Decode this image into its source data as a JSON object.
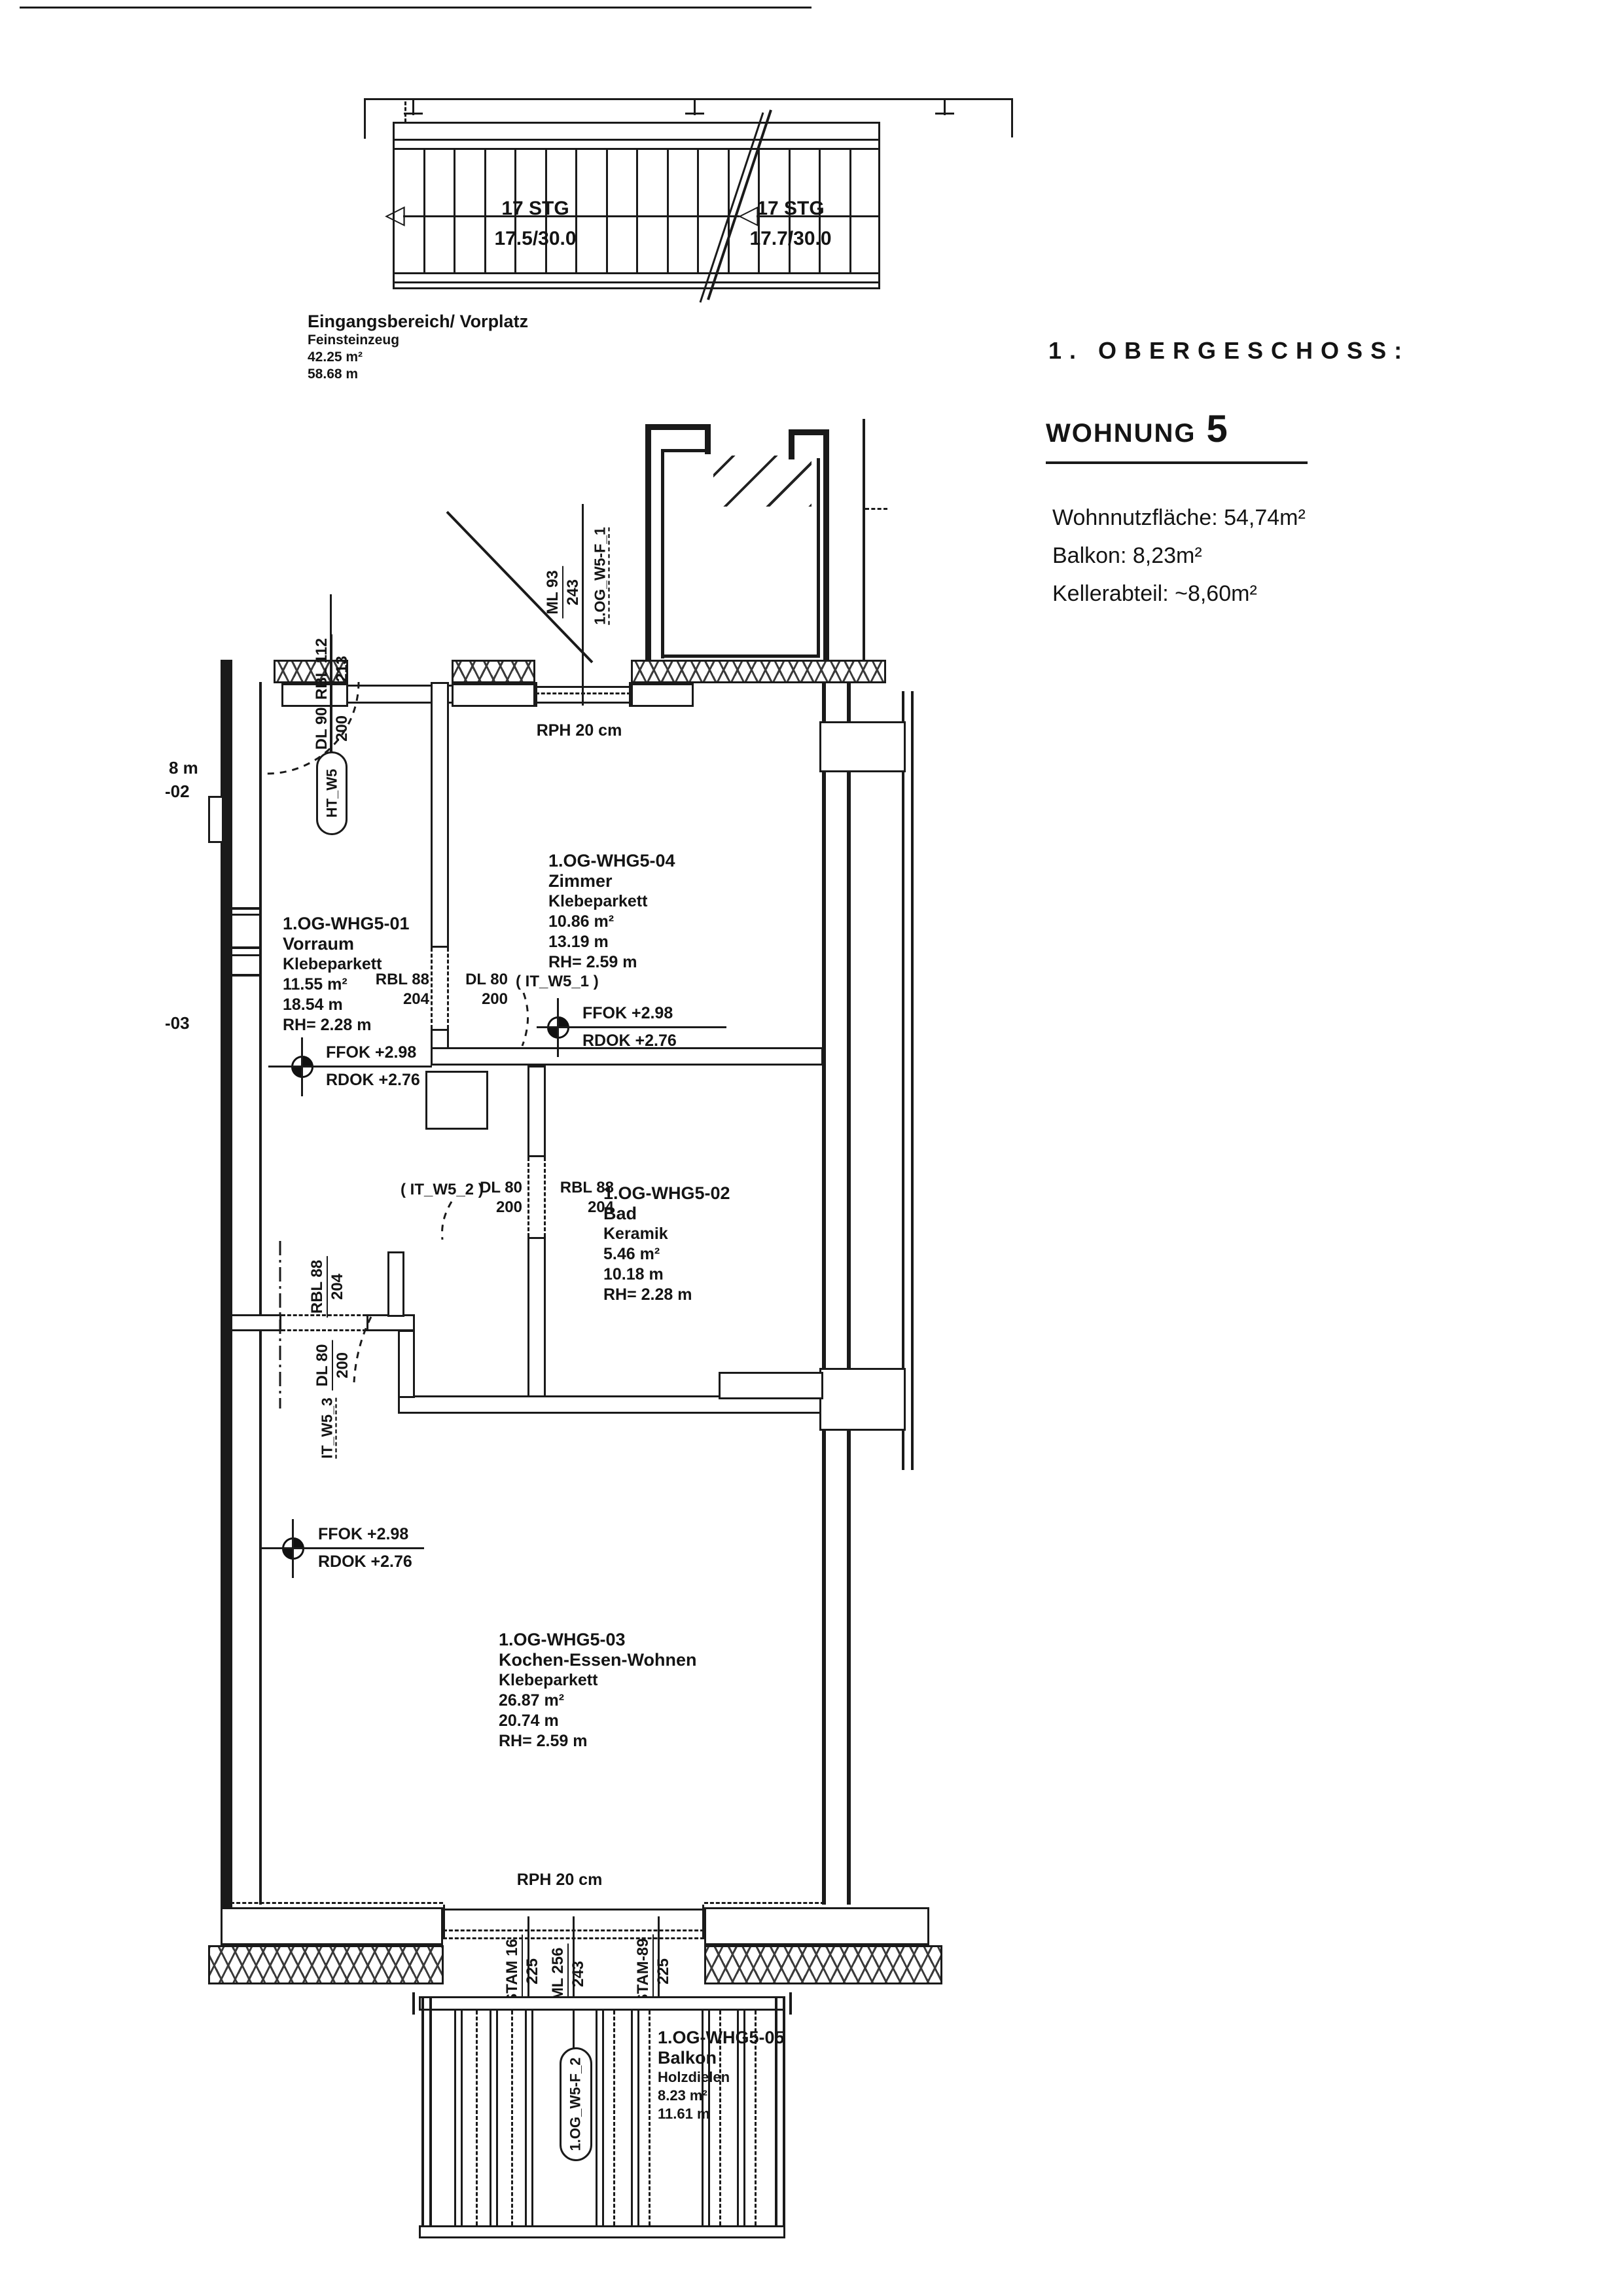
{
  "page": {
    "floor_title": "1. OBERGESCHOSS:",
    "unit_label": "WOHNUNG",
    "unit_number": "5",
    "living_area": "Wohnnutzfläche: 54,74m²",
    "balcony_area": "Balkon: 8,23m²",
    "cellar_area": "Kellerabteil: ~8,60m²"
  },
  "stairs": {
    "flight1_steps": "17 STG",
    "flight1_dim": "17.5/30.0",
    "flight2_steps": "17 STG",
    "flight2_dim": "17.7/30.0"
  },
  "entrance": {
    "name": "Eingangsbereich/ Vorplatz",
    "finish": "Feinsteinzeug",
    "area": "42.25 m²",
    "perimeter": "58.68 m"
  },
  "rooms": {
    "vorraum": {
      "id": "1.OG-WHG5-01",
      "name": "Vorraum",
      "finish": "Klebeparkett",
      "area": "11.55 m²",
      "perimeter": "18.54 m",
      "height": "RH= 2.28 m"
    },
    "zimmer": {
      "id": "1.OG-WHG5-04",
      "name": "Zimmer",
      "finish": "Klebeparkett",
      "area": "10.86 m²",
      "perimeter": "13.19 m",
      "height": "RH= 2.59 m"
    },
    "bad": {
      "id": "1.OG-WHG5-02",
      "name": "Bad",
      "finish": "Keramik",
      "area": "5.46 m²",
      "perimeter": "10.18 m",
      "height": "RH= 2.28 m"
    },
    "kochen": {
      "id": "1.OG-WHG5-03",
      "name": "Kochen-Essen-Wohnen",
      "finish": "Klebeparkett",
      "area": "26.87 m²",
      "perimeter": "20.74 m",
      "height": "RH= 2.59 m"
    },
    "balkon": {
      "id": "1.OG-WHG5-05",
      "name": "Balkon",
      "finish": "Holzdielen",
      "area": "8.23 m²",
      "perimeter": "11.61 m"
    }
  },
  "levels": {
    "ffok": "FFOK +2.98",
    "rdok": "RDOK +2.76"
  },
  "doors": {
    "entry": {
      "tag": "HT_W5",
      "dl": "DL 90",
      "dl_h": "200",
      "rbl": "RBL 112",
      "rbl_h": "213"
    },
    "window_top": {
      "tag": "1.OG_W5-F_1",
      "ml": "ML 93",
      "ml_h": "243"
    },
    "zimmer": {
      "rbl": "RBL 88",
      "rbl_h": "204",
      "dl": "DL 80",
      "dl_h": "200",
      "it": "( IT_W5_1 )"
    },
    "bad": {
      "it": "( IT_W5_2 )",
      "dl": "DL 80",
      "dl_h": "200",
      "rbl": "RBL 88",
      "rbl_h": "204"
    },
    "kochen": {
      "rbl": "RBL 88",
      "rbl_h": "204",
      "dl": "DL 80",
      "dl_h": "200",
      "it": "IT_W5_3"
    },
    "balcony": {
      "tag": "1.OG_W5-F_2",
      "ml": "ML 256",
      "ml_h": "243",
      "stam_left": "STAM 16",
      "stam_left_h": "225",
      "stam_right": "STAM-89",
      "stam_right_h": "225"
    }
  },
  "annotations": {
    "rph": "RPH 20 cm",
    "margin_8m": "8 m",
    "margin_02": "-02",
    "margin_03": "-03"
  },
  "colors": {
    "ink": "#1a1a1a",
    "paper": "#ffffff"
  }
}
